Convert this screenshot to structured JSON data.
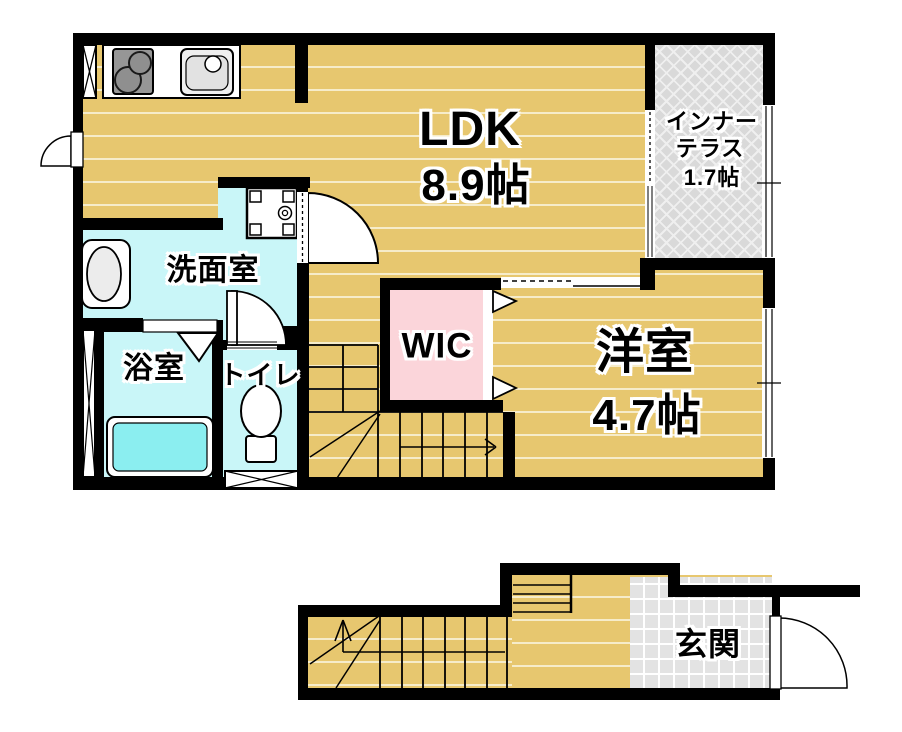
{
  "floor_plan": {
    "rooms": {
      "ldk": {
        "label": "LDK",
        "area": "8.9帖"
      },
      "inner_terrace": {
        "label_line1": "インナー",
        "label_line2": "テラス",
        "area": "1.7帖"
      },
      "washroom": {
        "label": "洗面室"
      },
      "bathroom": {
        "label": "浴室"
      },
      "toilet": {
        "label": "トイレ"
      },
      "wic": {
        "label": "WIC"
      },
      "western_room": {
        "label": "洋室",
        "area": "4.7帖"
      },
      "entrance": {
        "label": "玄関"
      }
    },
    "colors": {
      "wall": "#000000",
      "wood_floor": "#e7c76f",
      "wood_plank_line": "#f6ecca",
      "wet_area": "#c9f6f8",
      "bathtub": "#8beef0",
      "wic_floor": "#fbd5da",
      "terrace_floor": "#d9d9d9",
      "entrance_tile": "#e3e3e3"
    }
  }
}
